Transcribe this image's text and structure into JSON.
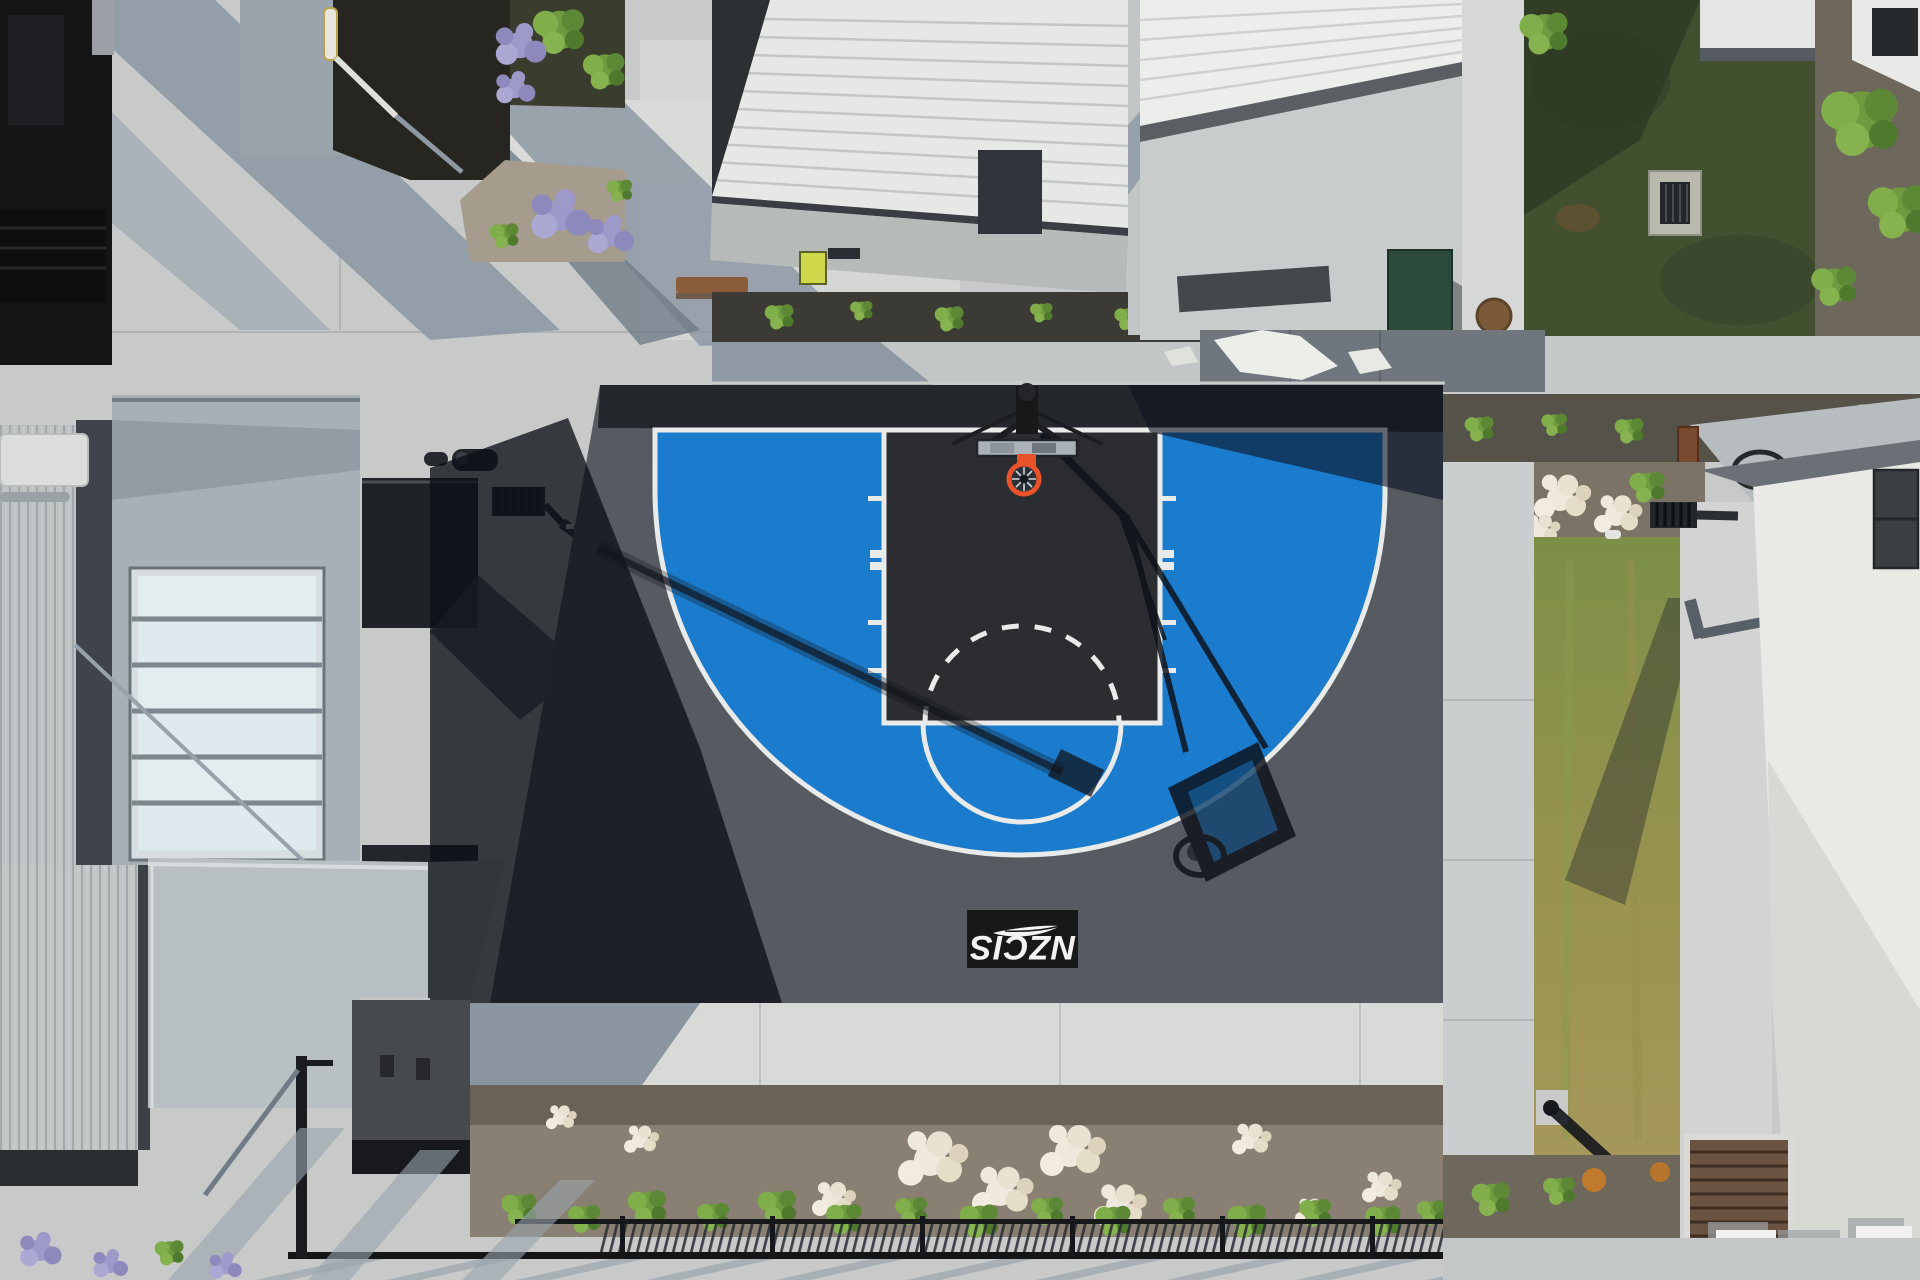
{
  "meta": {
    "title": "Aerial drone view of NZCIS outdoor basketball half-court",
    "view": "top-down",
    "lighting": "sunny, long hard shadows"
  },
  "court": {
    "logo": {
      "text": "NZCIS",
      "icon": "silver-fern-icon",
      "rotation_deg": 180
    },
    "colors": {
      "three_point_zone_blue": "#1b7bcc",
      "blue_in_shadow": "#123a5e",
      "key_black": "#2b2d30",
      "surface_gray": "#565b61",
      "out_of_bounds_strip": "#24272c",
      "line_white": "#e9ebea",
      "rim_orange": "#e8532a",
      "logo_bg": "#17181a",
      "logo_text_color": "#f2f3f1"
    },
    "markings": [
      "baseline",
      "three-point-arc",
      "key",
      "free-throw-line",
      "free-throw-circle-solid",
      "free-throw-circle-dashed",
      "hash-marks",
      "center-logo"
    ]
  },
  "environment": {
    "colors": {
      "concrete_light": "#c7cac9",
      "concrete_bright": "#dcdeda",
      "concrete_shadow": "#8e99a4",
      "lawn_green": "#42502f",
      "grass_strip_green": "#7c8f47",
      "grass_strip_dry": "#a5975a",
      "mulch_brown": "#897f72",
      "dark_mulch": "#26251f",
      "shrub_green": "#7fa33c",
      "flower_white": "#efe9dd",
      "flower_purple": "#9d99c9",
      "white_roof": "#e9eae6",
      "metal_roof_gray": "#b4babd",
      "dark_roof": "#2b2e31",
      "wood_brown": "#8a5c39",
      "utility_cabinet_green": "#2c4a39",
      "louver_brown": "#6b5342",
      "rust_brown": "#7a5a38"
    },
    "objects": [
      "apartment-buildings",
      "walkways",
      "garden-beds",
      "lawn",
      "storm-drain",
      "manhole-cover",
      "metal-fence",
      "light-poles",
      "picnic-table",
      "timber-bench",
      "wire-chairs",
      "utility-cabinet",
      "skylight",
      "rooftop-units",
      "aed-box"
    ]
  }
}
